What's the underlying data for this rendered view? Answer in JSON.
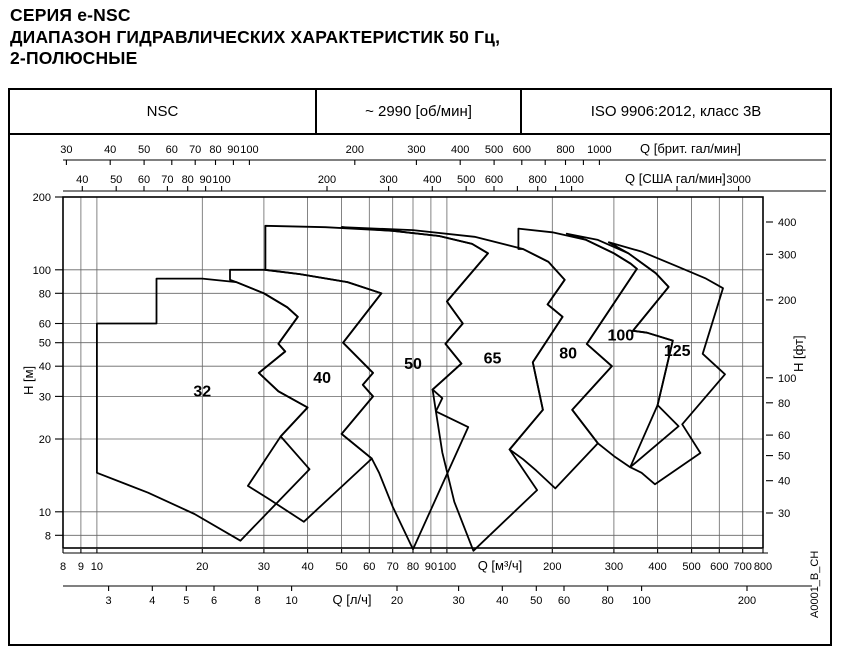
{
  "title": {
    "line1": "СЕРИЯ e-NSC",
    "line2": "ДИАПАЗОН ГИДРАВЛИЧЕСКИХ ХАРАКТЕРИСТИК 50 Гц,",
    "line3": "2-ПОЛЮСНЫЕ"
  },
  "header": {
    "series": "NSC",
    "speed": "~ 2990 [об/мин]",
    "standard": "ISO 9906:2012, класс 3В"
  },
  "caption_vertical": "A0001_B_CH",
  "chart_data": {
    "type": "area",
    "title": "Диапазон гидравлических характеристик NSC 50 Гц 2-полюсные",
    "legend": "none",
    "grid": {
      "vertical_q": [
        9,
        10,
        20,
        30,
        40,
        50,
        60,
        70,
        80,
        90,
        100,
        200,
        300,
        400,
        500,
        600,
        700
      ],
      "horizontal_h": [
        8,
        10,
        20,
        30,
        40,
        50,
        60,
        80,
        100
      ]
    },
    "axes": {
      "x_m3h": {
        "label": "Q [м³/ч]",
        "scale": "log",
        "range": [
          8,
          800
        ],
        "ticks": [
          8,
          9,
          10,
          20,
          30,
          40,
          50,
          60,
          70,
          80,
          90,
          100,
          200,
          300,
          400,
          500,
          600,
          700,
          800
        ]
      },
      "x_ls": {
        "label": "Q [л/ч]",
        "scale": "log",
        "ticks": [
          3,
          4,
          5,
          6,
          8,
          10,
          20,
          30,
          40,
          50,
          60,
          80,
          100,
          200
        ]
      },
      "x_imp": {
        "label": "Q [брит. гал/мин]",
        "scale": "log",
        "ticks": [
          30,
          40,
          50,
          60,
          70,
          80,
          90,
          100,
          200,
          300,
          400,
          500,
          600,
          800,
          1000
        ],
        "minor_ticks": [
          700,
          900
        ]
      },
      "x_us": {
        "label": "Q [США гал/мин]",
        "scale": "log",
        "ticks": [
          40,
          50,
          60,
          70,
          80,
          90,
          100,
          200,
          300,
          400,
          500,
          600,
          800,
          1000,
          3000
        ],
        "minor_ticks": [
          700,
          900,
          2000
        ]
      },
      "y_m": {
        "label": "H [м]",
        "scale": "log",
        "range": [
          7.1,
          200
        ],
        "ticks": [
          200,
          100,
          80,
          60,
          50,
          40,
          30,
          20,
          10,
          8
        ]
      },
      "y_ft": {
        "label": "H [фт]",
        "scale": "log",
        "ticks": [
          400,
          300,
          200,
          100,
          80,
          60,
          50,
          40,
          30
        ]
      }
    },
    "regions": [
      {
        "label": "32",
        "label_at": [
          20,
          30
        ],
        "points": [
          [
            10,
            14.5
          ],
          [
            10,
            60
          ],
          [
            14.8,
            60
          ],
          [
            14.8,
            92
          ],
          [
            20,
            92
          ],
          [
            25,
            89
          ],
          [
            30,
            80
          ],
          [
            35,
            70
          ],
          [
            37.5,
            64
          ],
          [
            33,
            49.5
          ],
          [
            34.5,
            46
          ],
          [
            29,
            37.5
          ],
          [
            33,
            31.5
          ],
          [
            40,
            27
          ],
          [
            33.5,
            20.5
          ],
          [
            40.5,
            15
          ],
          [
            25.7,
            7.6
          ],
          [
            19,
            9.8
          ],
          [
            14,
            12
          ]
        ]
      },
      {
        "label": "40",
        "label_at": [
          44,
          34
        ],
        "points": [
          [
            24,
            100
          ],
          [
            30.2,
            100
          ],
          [
            38,
            96
          ],
          [
            52,
            89
          ],
          [
            65,
            80
          ],
          [
            50.5,
            50
          ],
          [
            61.5,
            37.5
          ],
          [
            57.5,
            33.5
          ],
          [
            61.5,
            30
          ],
          [
            50,
            21
          ],
          [
            61,
            16.6
          ],
          [
            39,
            9.1
          ],
          [
            31,
            11.3
          ],
          [
            27,
            12.8
          ],
          [
            33.5,
            20.5
          ],
          [
            40,
            27
          ],
          [
            33,
            31.5
          ],
          [
            29,
            37.5
          ],
          [
            34.5,
            46
          ],
          [
            33,
            49.5
          ],
          [
            37.5,
            64
          ],
          [
            35,
            70
          ],
          [
            30,
            80
          ],
          [
            25,
            89
          ],
          [
            24,
            91
          ]
        ]
      },
      {
        "label": "50",
        "label_at": [
          80,
          39
        ],
        "points": [
          [
            30.3,
            100
          ],
          [
            30.3,
            152
          ],
          [
            45,
            150
          ],
          [
            70,
            145
          ],
          [
            95,
            138
          ],
          [
            118,
            128
          ],
          [
            131,
            117
          ],
          [
            100,
            74
          ],
          [
            111,
            60
          ],
          [
            99,
            49.5
          ],
          [
            110,
            41
          ],
          [
            91,
            32
          ],
          [
            97,
            29.5
          ],
          [
            93,
            26
          ],
          [
            115,
            22.4
          ],
          [
            80,
            7
          ],
          [
            70,
            10.5
          ],
          [
            64,
            14.5
          ],
          [
            61,
            16.6
          ],
          [
            50,
            21
          ],
          [
            61.5,
            30
          ],
          [
            57.5,
            33.5
          ],
          [
            61.5,
            37.5
          ],
          [
            50.5,
            50
          ],
          [
            65,
            80
          ],
          [
            52,
            89
          ],
          [
            38,
            96
          ],
          [
            30.2,
            100
          ]
        ]
      },
      {
        "label": "65",
        "label_at": [
          135,
          41
        ],
        "points": [
          [
            50,
            150
          ],
          [
            80,
            146
          ],
          [
            120,
            137
          ],
          [
            165,
            122
          ],
          [
            195,
            108
          ],
          [
            217,
            91
          ],
          [
            194,
            72
          ],
          [
            214,
            64
          ],
          [
            176,
            41.5
          ],
          [
            188,
            26.4
          ],
          [
            151,
            18.1
          ],
          [
            181,
            12.3
          ],
          [
            119,
            6.9
          ],
          [
            105,
            11
          ],
          [
            97,
            17.6
          ],
          [
            93,
            26
          ],
          [
            91,
            32
          ],
          [
            110,
            41
          ],
          [
            99,
            49.5
          ],
          [
            111,
            60
          ],
          [
            100,
            74
          ],
          [
            131,
            117
          ],
          [
            118,
            128
          ],
          [
            95,
            138
          ],
          [
            70,
            145
          ]
        ]
      },
      {
        "label": "80",
        "label_at": [
          222,
          43
        ],
        "points": [
          [
            160,
            148
          ],
          [
            200,
            143
          ],
          [
            250,
            133
          ],
          [
            300,
            117
          ],
          [
            335,
            106
          ],
          [
            349,
            101
          ],
          [
            251,
            49.4
          ],
          [
            296,
            40
          ],
          [
            228,
            26.4
          ],
          [
            270,
            19.2
          ],
          [
            204,
            12.5
          ],
          [
            180,
            14.8
          ],
          [
            165,
            16.5
          ],
          [
            151,
            18.1
          ],
          [
            188,
            26.4
          ],
          [
            176,
            41.5
          ],
          [
            214,
            64
          ],
          [
            194,
            72
          ],
          [
            217,
            91
          ],
          [
            195,
            108
          ],
          [
            165,
            122
          ],
          [
            160,
            122
          ]
        ]
      },
      {
        "label": "100",
        "label_at": [
          314,
          51
        ],
        "points": [
          [
            220,
            141
          ],
          [
            270,
            133
          ],
          [
            330,
            117
          ],
          [
            395,
            97
          ],
          [
            430,
            85
          ],
          [
            340,
            56
          ],
          [
            373,
            55
          ],
          [
            442,
            51
          ],
          [
            400,
            27.6
          ],
          [
            459,
            22.6
          ],
          [
            334,
            15.3
          ],
          [
            300,
            17
          ],
          [
            270,
            19.2
          ],
          [
            228,
            26.4
          ],
          [
            296,
            40
          ],
          [
            251,
            49.4
          ],
          [
            349,
            101
          ],
          [
            335,
            106
          ],
          [
            300,
            117
          ],
          [
            250,
            133
          ]
        ]
      },
      {
        "label": "125",
        "label_at": [
          455,
          44
        ],
        "points": [
          [
            290,
            130
          ],
          [
            360,
            119
          ],
          [
            450,
            104
          ],
          [
            550,
            92
          ],
          [
            615,
            84
          ],
          [
            538,
            45
          ],
          [
            623,
            37
          ],
          [
            470,
            23
          ],
          [
            530,
            17.5
          ],
          [
            393,
            13
          ],
          [
            360,
            14.5
          ],
          [
            334,
            15.3
          ],
          [
            400,
            27.6
          ],
          [
            442,
            51
          ],
          [
            373,
            55
          ],
          [
            340,
            56
          ],
          [
            430,
            85
          ],
          [
            395,
            97
          ],
          [
            330,
            117
          ]
        ]
      }
    ]
  }
}
